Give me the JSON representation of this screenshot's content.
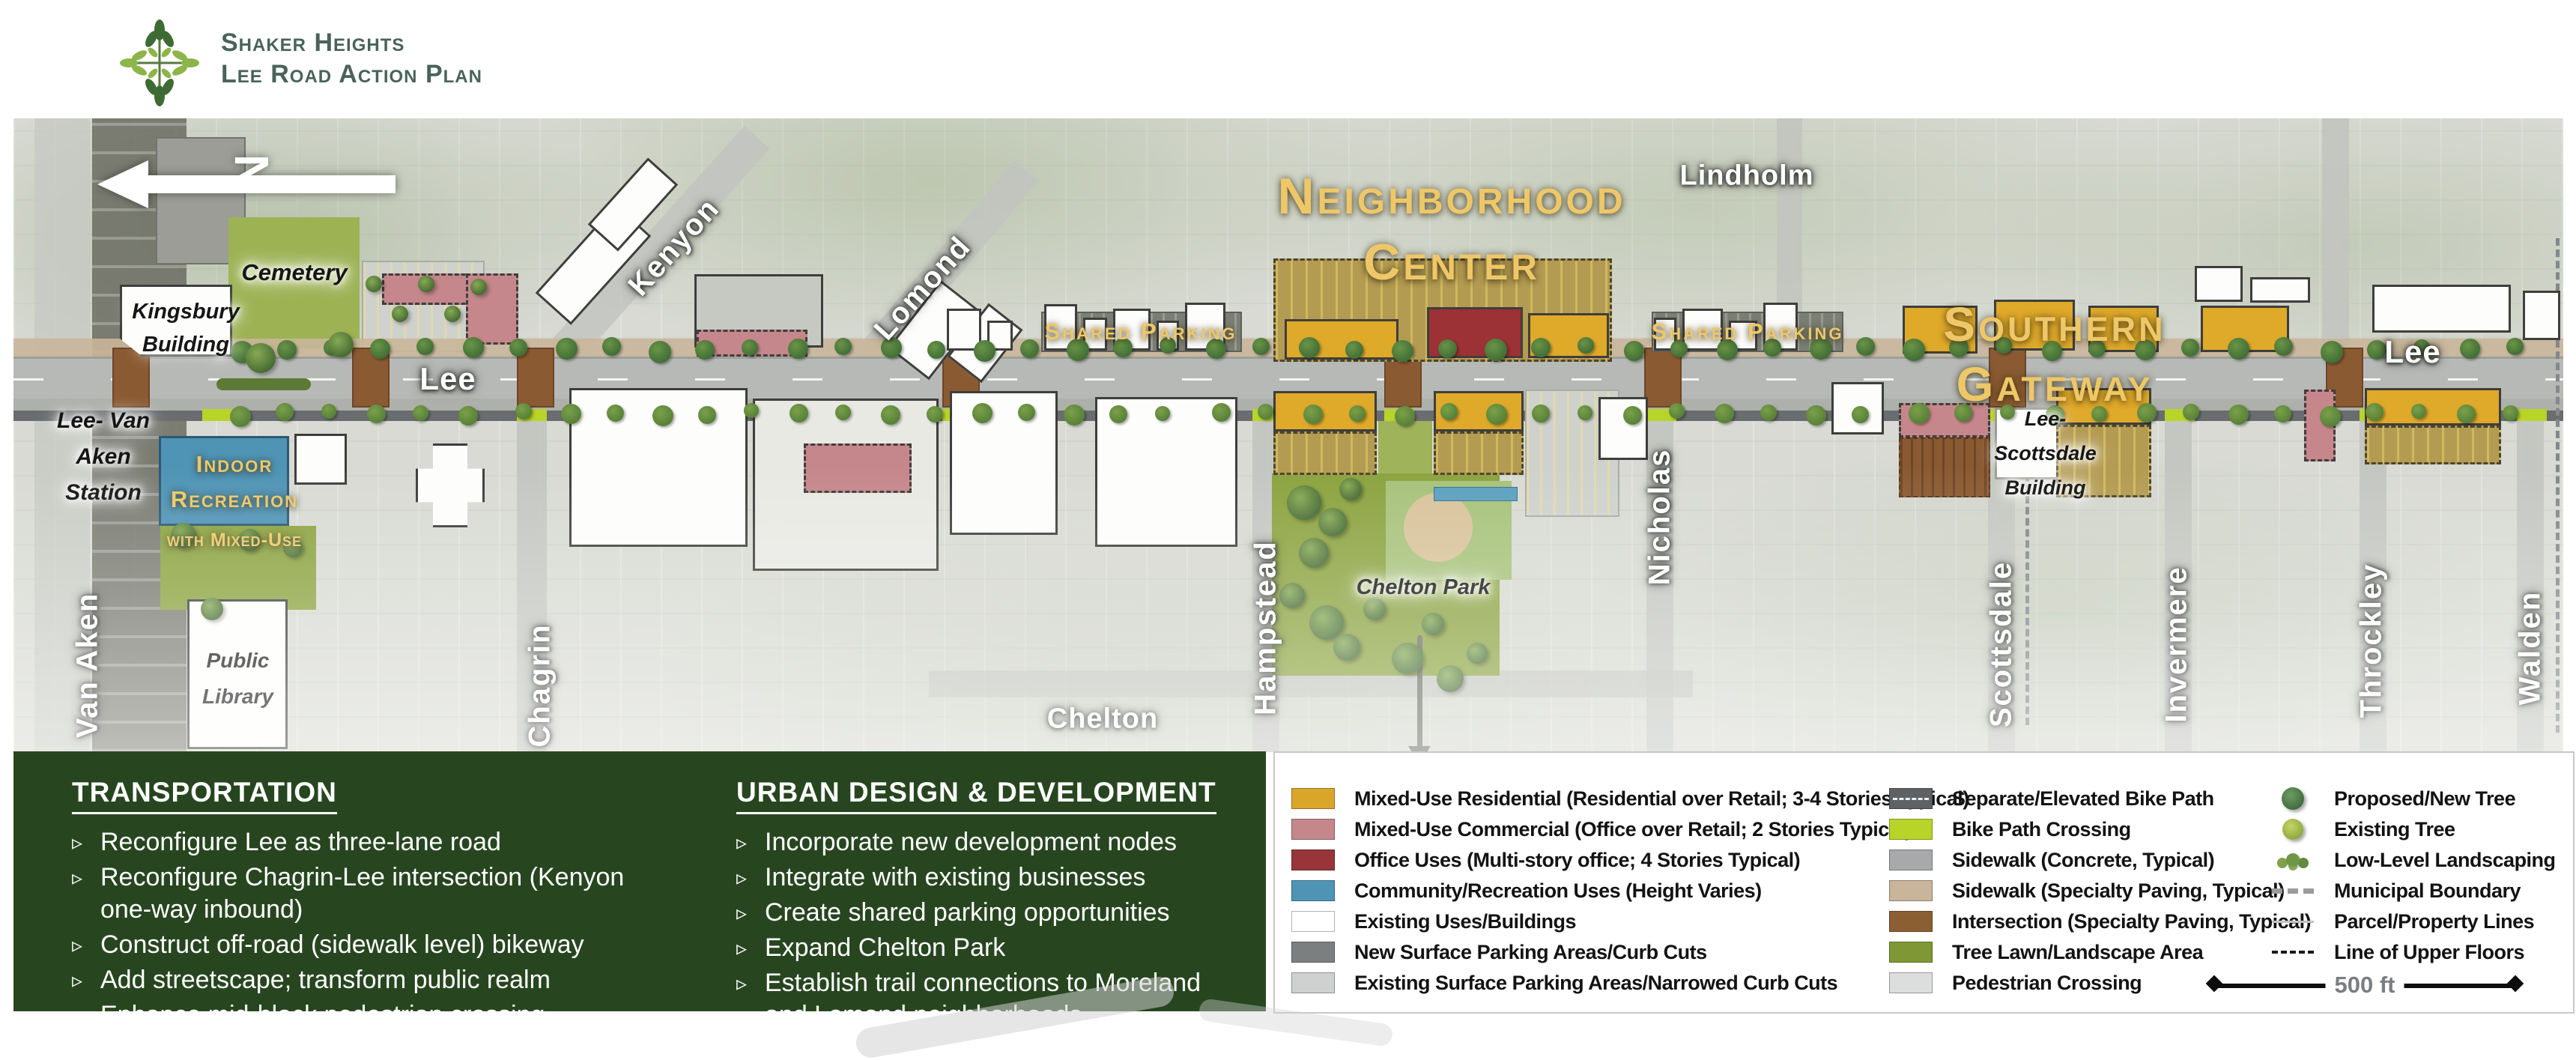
{
  "header": {
    "org": "Shaker Heights",
    "plan": "Lee Road Action Plan"
  },
  "map": {
    "north_label": "N",
    "districts": {
      "neighborhood_center_line1": "Neighborhood",
      "neighborhood_center_line2": "Center",
      "southern_gateway_line1": "Southern",
      "southern_gateway_line2": "Gateway",
      "shared_parking_left": "Shared Parking",
      "shared_parking_right": "Shared Parking"
    },
    "streets": {
      "lee_west": "Lee",
      "lee_east": "Lee",
      "kenyon": "Kenyon",
      "lomond": "Lomond",
      "lindholm": "Lindholm",
      "chelton": "Chelton",
      "van_aken": "Van Aken",
      "chagrin": "Chagrin",
      "hampstead": "Hampstead",
      "nicholas": "Nicholas",
      "scottsdale": "Scottsdale",
      "invermere": "Invermere",
      "throckley": "Throckley",
      "walden": "Walden"
    },
    "places": {
      "cemetery": "Cemetery",
      "kingsbury_line1": "Kingsbury",
      "kingsbury_line2": "Building",
      "station_line1": "Lee- Van",
      "station_line2": "Aken",
      "station_line3": "Station",
      "indoor_line1": "Indoor",
      "indoor_line2": "Recreation",
      "indoor_line3": "with Mixed-Use",
      "library_line1": "Public",
      "library_line2": "Library",
      "chelton_park": "Chelton Park",
      "lee_scottsdale_line1": "Lee-",
      "lee_scottsdale_line2": "Scottsdale",
      "lee_scottsdale_line3": "Building"
    }
  },
  "panels": {
    "bullet_glyph": "▹",
    "transportation": {
      "title": "TRANSPORTATION",
      "items": [
        "Reconfigure Lee as three-lane road",
        "Reconfigure Chagrin-Lee intersection (Kenyon one-way inbound)",
        "Construct off-road (sidewalk level) bikeway",
        "Add streetscape; transform public realm",
        "Enhance mid-block pedestrian crossing"
      ]
    },
    "urban_design": {
      "title": "URBAN DESIGN & DEVELOPMENT",
      "items": [
        "Incorporate new development nodes",
        "Integrate with existing businesses",
        "Create shared parking opportunities",
        "Expand Chelton Park",
        "Establish trail connections to Moreland and Lomond neighborhoods"
      ]
    }
  },
  "legend": {
    "land_use": [
      {
        "label": "Mixed-Use Residential (Residential over Retail; 3-4 Stories Typical)",
        "color": "#d9a62a"
      },
      {
        "label": "Mixed-Use Commercial (Office over Retail; 2 Stories Typical)",
        "color": "#c5878b"
      },
      {
        "label": "Office Uses (Multi-story office; 4 Stories Typical)",
        "color": "#97353a"
      },
      {
        "label": "Community/Recreation Uses (Height Varies)",
        "color": "#4f94b5"
      },
      {
        "label": "Existing Uses/Buildings",
        "color": "#ffffff"
      },
      {
        "label": "New Surface Parking Areas/Curb Cuts",
        "color": "#7c7f80"
      },
      {
        "label": "Existing Surface Parking Areas/Narrowed Curb Cuts",
        "color": "#cfd1d0"
      }
    ],
    "streetscape": [
      {
        "label": "Separate/Elevated Bike Path",
        "color": "#5f6265"
      },
      {
        "label": "Bike Path Crossing",
        "color": "#b8d428"
      },
      {
        "label": "Sidewalk (Concrete, Typical)",
        "color": "#a7a9ab"
      },
      {
        "label": "Sidewalk (Specialty Paving, Typical)",
        "color": "#c9b59a"
      },
      {
        "label": "Intersection (Specialty Paving, Typical)",
        "color": "#8c5f33"
      },
      {
        "label": "Tree Lawn/Landscape Area",
        "color": "#7f9734"
      },
      {
        "label": "Pedestrian Crossing",
        "color": "#dcdddd"
      }
    ],
    "symbols": [
      {
        "label": "Proposed/New Tree",
        "color": "#4c7d49"
      },
      {
        "label": "Existing Tree",
        "color": "#a3bd4e"
      },
      {
        "label": "Low-Level Landscaping",
        "color": "#6f9547"
      },
      {
        "label": "Municipal Boundary",
        "color": "#9a9c9e"
      },
      {
        "label": "Parcel/Property Lines",
        "color": "#c0c2c3"
      },
      {
        "label": "Line of Upper Floors",
        "color": "#1a1a1a"
      }
    ],
    "scale_label": "500 ft"
  }
}
